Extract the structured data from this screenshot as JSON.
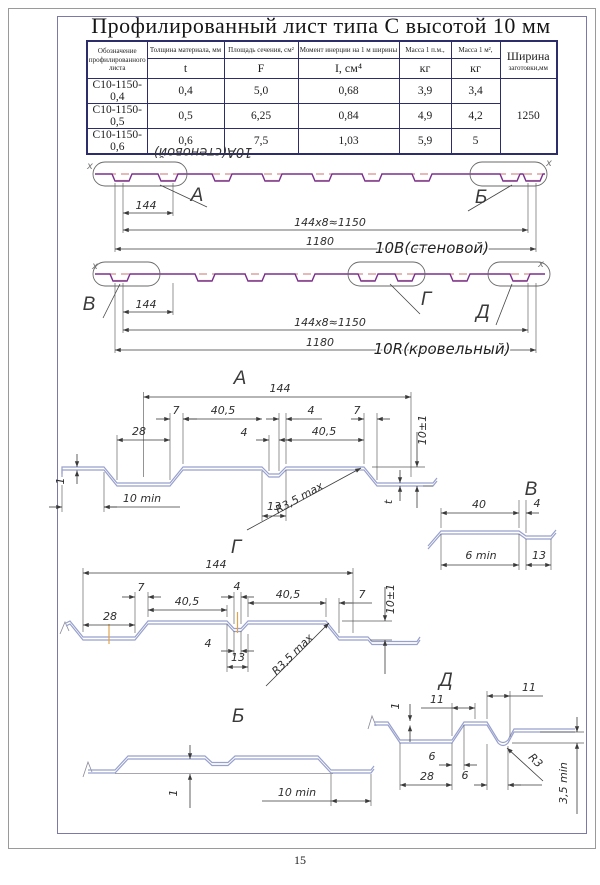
{
  "title": "Профилированный лист типа С высотой 10 мм",
  "page_number": "15",
  "table": {
    "h_name": "Обозначение профилированного листа",
    "h_t_name": "Толщина материала, мм",
    "h_t_sym": "t",
    "h_f_name": "Площадь сечения, см²",
    "h_f_sym": "F",
    "h_i_name": "Момент инерции на 1 м ширины",
    "h_i_sym": "I, см⁴",
    "h_m1_name": "Масса 1 п.м.,",
    "h_m1_sym": "кг",
    "h_m2_name": "Масса 1 м²,",
    "h_m2_sym": "кг",
    "h_w1": "Ширина",
    "h_w2": "заготовки,мм",
    "rows": [
      {
        "name": "С10-1150-0,4",
        "t": "0,4",
        "F": "5,0",
        "I": "0,68",
        "m1": "3,9",
        "m2": "3,4"
      },
      {
        "name": "С10-1150-0,5",
        "t": "0,5",
        "F": "6,25",
        "I": "0,84",
        "m1": "4,9",
        "m2": "4,2"
      },
      {
        "name": "С10-1150-0,6",
        "t": "0,6",
        "F": "7,5",
        "I": "1,03",
        "m1": "5,9",
        "m2": "5"
      }
    ],
    "width_value": "1250"
  },
  "view_wall": {
    "label_flipped": "10А(стеновой)",
    "axis_mark": "х",
    "detail_a": "А",
    "detail_b": "Б",
    "dim_module": "144",
    "dim_modules": "144х8≈1150",
    "dim_width": "1180",
    "name": "10В(стеновой)"
  },
  "view_roof": {
    "axis_mark": "х",
    "detail_v": "В",
    "detail_g": "Г",
    "detail_d": "Д",
    "dim_module": "144",
    "dim_modules": "144х8≈1150",
    "dim_width": "1180",
    "name": "10R(кровельный)"
  },
  "sec_a": {
    "title": "А",
    "dim_144": "144",
    "dim_7l": "7",
    "dim_405l": "40,5",
    "dim_4r": "4",
    "dim_7r": "7",
    "dim_28": "28",
    "dim_4m": "4",
    "dim_405r": "40,5",
    "dim_h": "10±1",
    "dim_1": "1",
    "dim_10min": "10 min",
    "dim_13": "13",
    "dim_r": "R3,5 max",
    "dim_t": "t"
  },
  "sec_v": {
    "title": "В",
    "dim_40": "40",
    "dim_4": "4",
    "dim_6min": "6 min",
    "dim_13": "13"
  },
  "sec_g": {
    "title": "Г",
    "dim_144": "144",
    "dim_7l": "7",
    "dim_405l": "40,5",
    "dim_4t": "4",
    "dim_405r": "40,5",
    "dim_7r": "7",
    "dim_h": "10±1",
    "dim_28": "28",
    "dim_4b": "4",
    "dim_13": "13",
    "dim_r": "R3,5 max"
  },
  "sec_b": {
    "title": "Б",
    "dim_1": "1",
    "dim_10min": "10 min"
  },
  "sec_d": {
    "title": "Д",
    "dim_1": "1",
    "dim_11l": "11",
    "dim_11r": "11",
    "dim_6l": "6",
    "dim_28": "28",
    "dim_6r": "6",
    "dim_r": "R3",
    "dim_35min": "3,5 min"
  }
}
